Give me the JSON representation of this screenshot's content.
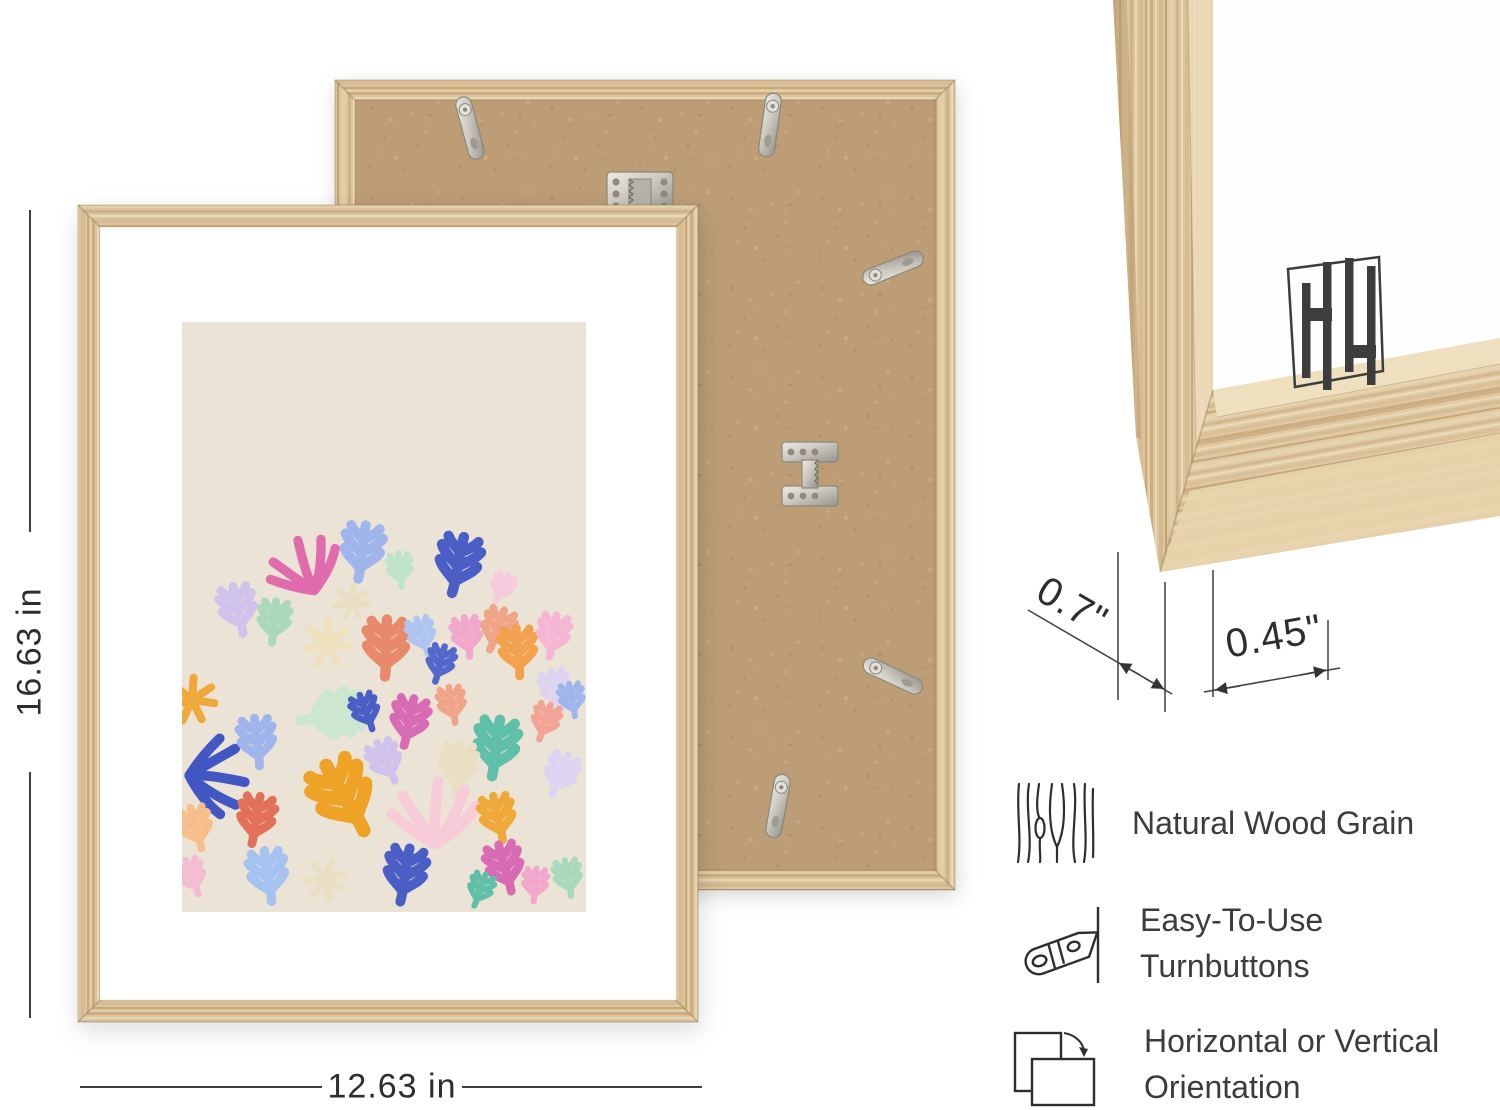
{
  "dimensions": {
    "height": "16.63 in",
    "width": "12.63 in",
    "depth": "0.7\"",
    "face_width": "0.45\""
  },
  "features": [
    {
      "icon": "wood-grain-icon",
      "label": "Natural Wood Grain"
    },
    {
      "icon": "turnbutton-icon",
      "label": "Easy-To-Use Turnbuttons"
    },
    {
      "icon": "orientation-icon",
      "label": "Horizontal or Vertical Orientation"
    }
  ],
  "colors": {
    "wood": "#DCC49E",
    "wood_shadow": "#C9A878",
    "mdf_backing": "#BC9D76",
    "art_background": "#EBE4D6",
    "metal_hardware": "#CCCAC2",
    "annotation_text": "#3C3C3C",
    "art_palette": [
      "#E06CAE",
      "#9FB5EC",
      "#4A5EC6",
      "#A9D8BA",
      "#5FBFA8",
      "#E8896C",
      "#F2A24E",
      "#EFA83A",
      "#CFC3EC",
      "#F4B6D2",
      "#EFE0BE",
      "#A5C2F0",
      "#D86CB4",
      "#F0A488",
      "#CCE7CF",
      "#DDD4F2",
      "#F8CBD8"
    ]
  }
}
